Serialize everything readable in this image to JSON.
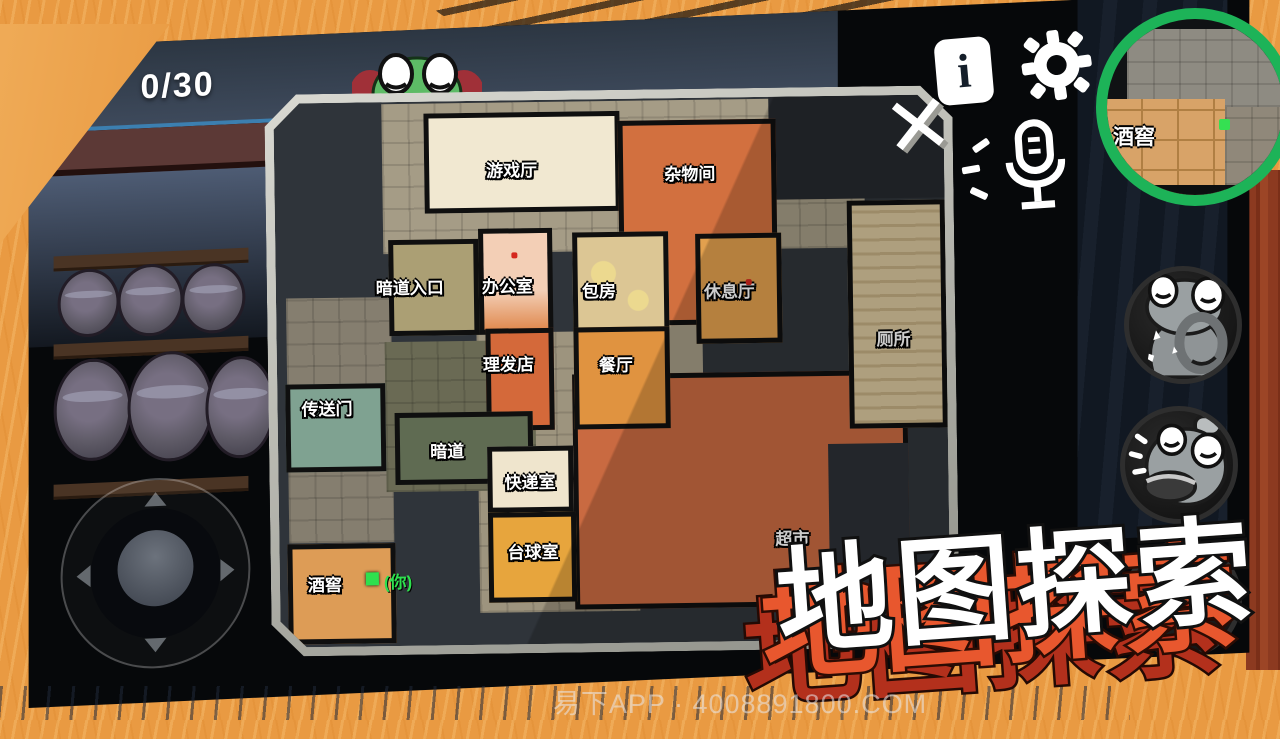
{
  "hud": {
    "counter": "0/30",
    "info_label": "i",
    "close_label": "✕",
    "watermark": "易下APP · 4008891800.COM"
  },
  "title": {
    "text": "地图探索"
  },
  "minimap": {
    "room_label": "酒窖"
  },
  "map": {
    "player_marker": "(你)",
    "rooms": [
      {
        "label": "游戏厅"
      },
      {
        "label": "杂物间"
      },
      {
        "label": "暗道入口"
      },
      {
        "label": "办公室"
      },
      {
        "label": "包房"
      },
      {
        "label": "休息厅"
      },
      {
        "label": "厕所"
      },
      {
        "label": "理发店"
      },
      {
        "label": "餐厅"
      },
      {
        "label": "传送门"
      },
      {
        "label": "暗道"
      },
      {
        "label": "快递室"
      },
      {
        "label": "台球室"
      },
      {
        "label": "酒窖"
      },
      {
        "label": "超市"
      }
    ]
  },
  "colors": {
    "background_orange": "#e99a42",
    "minimap_ring_green": "#1db358",
    "player_green": "#2ee04e",
    "title_white": "#ffffff",
    "title_shadow_orange": "#e8572e",
    "title_shadow_red": "#b3301c",
    "wall_black": "#0f0f0f"
  }
}
